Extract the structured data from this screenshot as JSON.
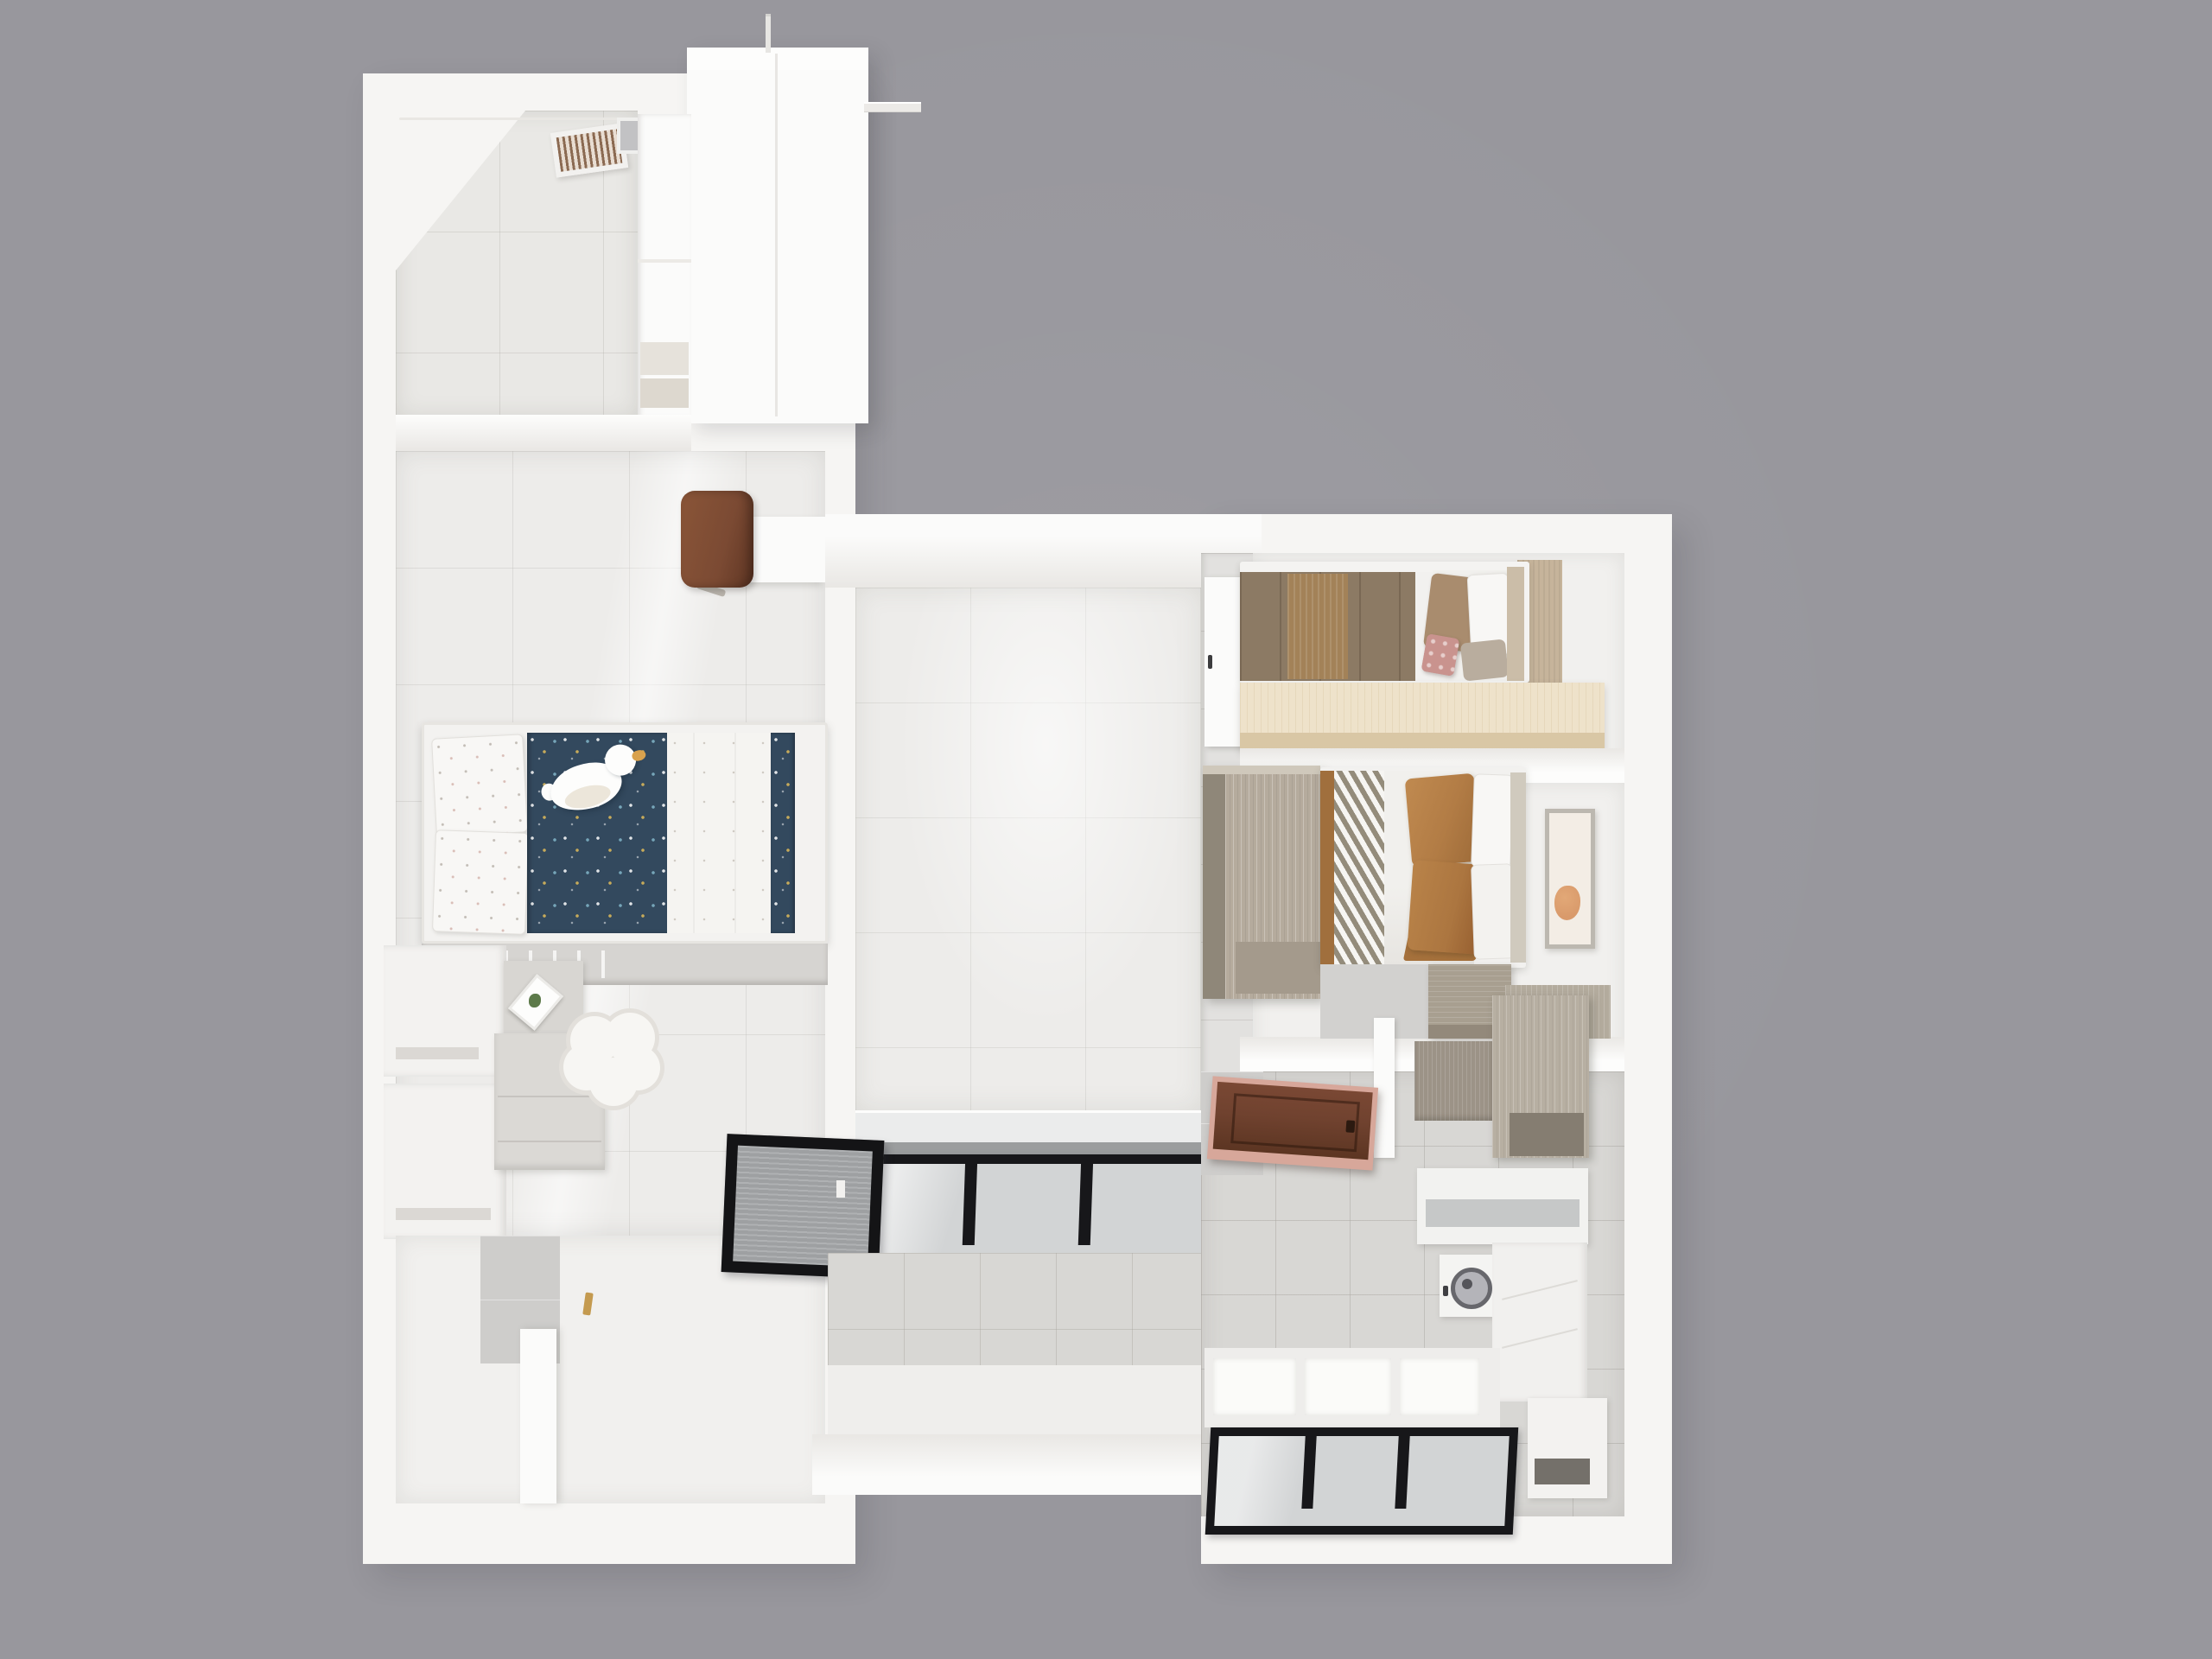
{
  "scene": {
    "label": "Top-down 3D rendered floor plan of an apartment on a gray background"
  },
  "colors": {
    "background": "#98979d",
    "wall": "#f6f5f3",
    "wall_shade": "#e9e7e4",
    "wall_bright": "#fbfbfa",
    "floor_living": "#edecea",
    "floor_balcony": "#e9e8e5",
    "floor_gray_tile": "#d8d7d4",
    "floor_white": "#f1f0ee",
    "tile_wall": "#cecdcb",
    "navy_duvet": "#33495e",
    "pillow_white": "#f8f7f5",
    "blanket_white": "#f5f4f1",
    "duck_white": "#fdfdfc",
    "duck_beak": "#d9a24e",
    "bench_gray": "#d6d4d1",
    "cabinet_white": "#f3f2f0",
    "cabinet_gray": "#dbd9d5",
    "stool_white": "#f7f6f3",
    "brass": "#c49a4f",
    "window_black": "#17171a",
    "window_glass": "#d2d4d5",
    "window_silver": "#9b9d9e",
    "screen_mesh": "#9ea0a2",
    "duvet_brown": "#8c7a64",
    "duvet_brown_light": "#a38258",
    "pillow_brown": "#a98c6e",
    "cushion_pink": "#c9938e",
    "headboard_tan": "#cbbda8",
    "cabinet_cream": "#eee2ca",
    "cabinet_cream_edge": "#d9c7a5",
    "wardrobe_face": "#b5ab9d",
    "wardrobe_side": "#8f8779",
    "chevron_dark": "#948c7b",
    "sheet_white": "#f1f0ed",
    "pillow_caramel": "#b27c45",
    "art_bg": "#f3ede5",
    "art_accent": "#d99a6b",
    "desk_wood": "#a89f90",
    "door_brown": "#70422f",
    "door_frame_pink": "#d7a79a",
    "kitchen_wood": "#b7afa2",
    "kitchen_wood_dark": "#9c9387",
    "counter_gray": "#c6c8c8",
    "washer_ring": "#67676c",
    "chair_brown": "#7b4a33"
  }
}
